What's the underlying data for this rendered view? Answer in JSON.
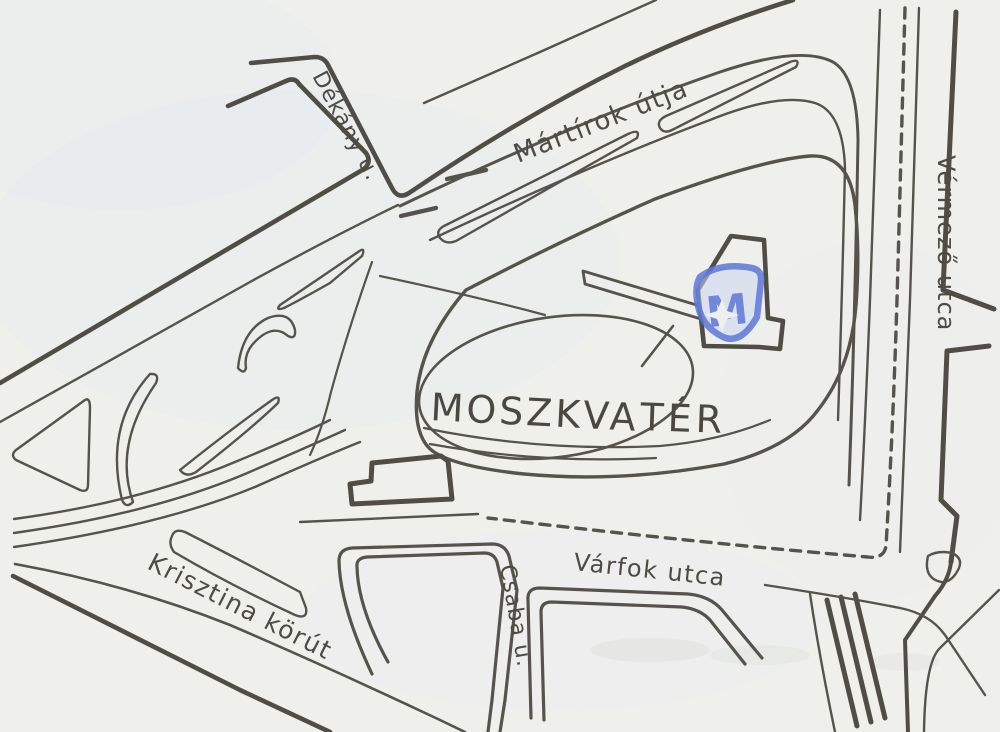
{
  "map": {
    "title": "Moszkva tér environs sketch map",
    "square": {
      "line1": "MOSZKVA",
      "line2": "TÉR"
    },
    "streets": {
      "dekany": "Dékány u.",
      "martirok": "Mártírok útja",
      "vermezo": "Vérmező utca",
      "varfok": "Várfok utca",
      "csaba": "Csaba u.",
      "krisztina": "Krisztina körút"
    },
    "metro_logo": {
      "letter": "M"
    },
    "colors": {
      "paper": "#eff0ec",
      "ink": "#55534b",
      "metro_blue": "#5d77d8",
      "metro_fill": "#ccd6f0"
    }
  }
}
